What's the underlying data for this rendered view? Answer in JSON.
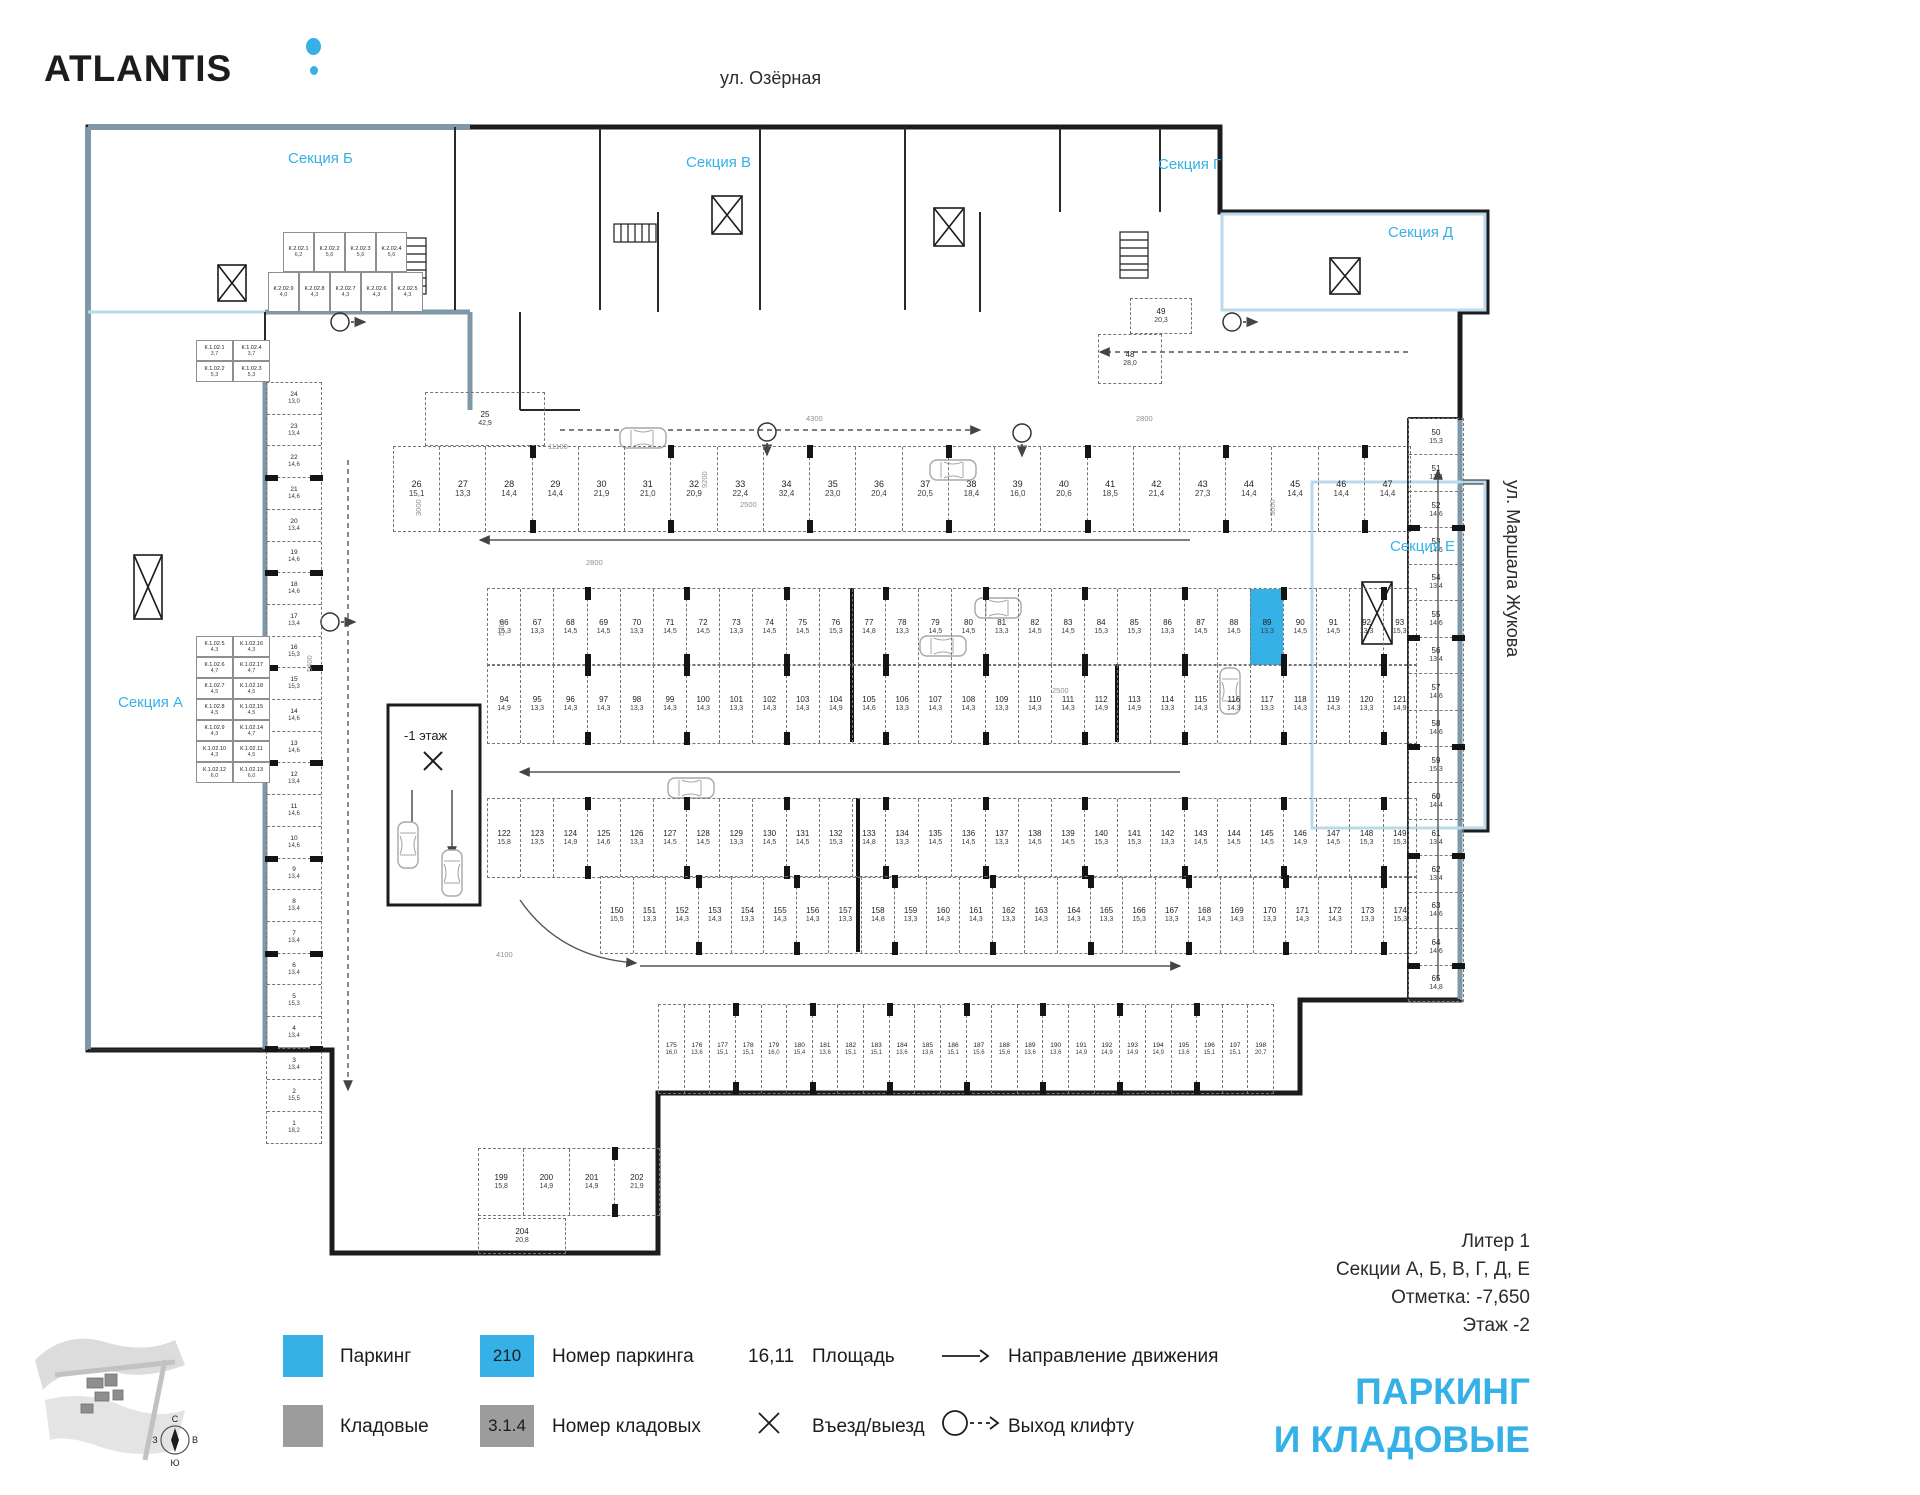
{
  "brand": {
    "name": "ATLANTIS"
  },
  "streets": {
    "top": "ул. Озёрная",
    "right": "ул. Маршала Жукова"
  },
  "section_labels": {
    "a": "Секция А",
    "b": "Секция Б",
    "v": "Секция В",
    "g": "Секция Г",
    "d": "Секция Д",
    "e": "Секция Е"
  },
  "ramp": {
    "label": "-1 этаж"
  },
  "selected_stall": "89",
  "colors": {
    "accent_cyan": "#35b1e7",
    "legend_gray": "#9c9c9c",
    "wall_black": "#1c1c1c",
    "wall_slate": "#7e97a9",
    "wall_lightblue": "#bcd9ec"
  },
  "rows": {
    "top": [
      {
        "n": "26",
        "a": "15,1"
      },
      {
        "n": "27",
        "a": "13,3"
      },
      {
        "n": "28",
        "a": "14,4"
      },
      {
        "n": "29",
        "a": "14,4"
      },
      {
        "n": "30",
        "a": "21,9"
      },
      {
        "n": "31",
        "a": "21,0"
      },
      {
        "n": "32",
        "a": "20,9"
      },
      {
        "n": "33",
        "a": "22,4"
      },
      {
        "n": "34",
        "a": "32,4"
      },
      {
        "n": "35",
        "a": "23,0"
      },
      {
        "n": "36",
        "a": "20,4"
      },
      {
        "n": "37",
        "a": "20,5"
      },
      {
        "n": "38",
        "a": "18,4"
      },
      {
        "n": "39",
        "a": "16,0"
      },
      {
        "n": "40",
        "a": "20,6"
      },
      {
        "n": "41",
        "a": "18,5"
      },
      {
        "n": "42",
        "a": "21,4"
      },
      {
        "n": "43",
        "a": "27,3"
      },
      {
        "n": "44",
        "a": "14,4"
      },
      {
        "n": "45",
        "a": "14,4"
      },
      {
        "n": "46",
        "a": "14,4"
      },
      {
        "n": "47",
        "a": "14,4"
      }
    ],
    "b1": [
      {
        "n": "66",
        "a": "15,3"
      },
      {
        "n": "67",
        "a": "13,3"
      },
      {
        "n": "68",
        "a": "14,5"
      },
      {
        "n": "69",
        "a": "14,5"
      },
      {
        "n": "70",
        "a": "13,3"
      },
      {
        "n": "71",
        "a": "14,5"
      },
      {
        "n": "72",
        "a": "14,5"
      },
      {
        "n": "73",
        "a": "13,3"
      },
      {
        "n": "74",
        "a": "14,5"
      },
      {
        "n": "75",
        "a": "14,5"
      },
      {
        "n": "76",
        "a": "15,3"
      },
      {
        "n": "77",
        "a": "14,8"
      },
      {
        "n": "78",
        "a": "13,3"
      },
      {
        "n": "79",
        "a": "14,5"
      },
      {
        "n": "80",
        "a": "14,5"
      },
      {
        "n": "81",
        "a": "13,3"
      },
      {
        "n": "82",
        "a": "14,5"
      },
      {
        "n": "83",
        "a": "14,5"
      },
      {
        "n": "84",
        "a": "15,3"
      },
      {
        "n": "85",
        "a": "15,3"
      },
      {
        "n": "86",
        "a": "13,3"
      },
      {
        "n": "87",
        "a": "14,5"
      },
      {
        "n": "88",
        "a": "14,5"
      },
      {
        "n": "89",
        "a": "13,3"
      },
      {
        "n": "90",
        "a": "14,5"
      },
      {
        "n": "91",
        "a": "14,5"
      },
      {
        "n": "92",
        "a": "13,3"
      },
      {
        "n": "93",
        "a": "15,3"
      }
    ],
    "b2": [
      {
        "n": "94",
        "a": "14,9"
      },
      {
        "n": "95",
        "a": "13,3"
      },
      {
        "n": "96",
        "a": "14,3"
      },
      {
        "n": "97",
        "a": "14,3"
      },
      {
        "n": "98",
        "a": "13,3"
      },
      {
        "n": "99",
        "a": "14,3"
      },
      {
        "n": "100",
        "a": "14,3"
      },
      {
        "n": "101",
        "a": "13,3"
      },
      {
        "n": "102",
        "a": "14,3"
      },
      {
        "n": "103",
        "a": "14,3"
      },
      {
        "n": "104",
        "a": "14,9"
      },
      {
        "n": "105",
        "a": "14,6"
      },
      {
        "n": "106",
        "a": "13,3"
      },
      {
        "n": "107",
        "a": "14,3"
      },
      {
        "n": "108",
        "a": "14,3"
      },
      {
        "n": "109",
        "a": "13,3"
      },
      {
        "n": "110",
        "a": "14,3"
      },
      {
        "n": "111",
        "a": "14,3"
      },
      {
        "n": "112",
        "a": "14,9"
      },
      {
        "n": "113",
        "a": "14,9"
      },
      {
        "n": "114",
        "a": "13,3"
      },
      {
        "n": "115",
        "a": "14,3"
      },
      {
        "n": "116",
        "a": "14,3"
      },
      {
        "n": "117",
        "a": "13,3"
      },
      {
        "n": "118",
        "a": "14,3"
      },
      {
        "n": "119",
        "a": "14,3"
      },
      {
        "n": "120",
        "a": "13,3"
      },
      {
        "n": "121",
        "a": "14,9"
      }
    ],
    "c1": [
      {
        "n": "122",
        "a": "15,8"
      },
      {
        "n": "123",
        "a": "13,5"
      },
      {
        "n": "124",
        "a": "14,9"
      },
      {
        "n": "125",
        "a": "14,6"
      },
      {
        "n": "126",
        "a": "13,3"
      },
      {
        "n": "127",
        "a": "14,5"
      },
      {
        "n": "128",
        "a": "14,5"
      },
      {
        "n": "129",
        "a": "13,3"
      },
      {
        "n": "130",
        "a": "14,5"
      },
      {
        "n": "131",
        "a": "14,5"
      },
      {
        "n": "132",
        "a": "15,3"
      },
      {
        "n": "133",
        "a": "14,8"
      },
      {
        "n": "134",
        "a": "13,3"
      },
      {
        "n": "135",
        "a": "14,5"
      },
      {
        "n": "136",
        "a": "14,5"
      },
      {
        "n": "137",
        "a": "13,3"
      },
      {
        "n": "138",
        "a": "14,5"
      },
      {
        "n": "139",
        "a": "14,5"
      },
      {
        "n": "140",
        "a": "15,3"
      },
      {
        "n": "141",
        "a": "15,3"
      },
      {
        "n": "142",
        "a": "13,3"
      },
      {
        "n": "143",
        "a": "14,5"
      },
      {
        "n": "144",
        "a": "14,5"
      },
      {
        "n": "145",
        "a": "14,5"
      },
      {
        "n": "146",
        "a": "14,9"
      },
      {
        "n": "147",
        "a": "14,5"
      },
      {
        "n": "148",
        "a": "15,3"
      },
      {
        "n": "149",
        "a": "15,3"
      }
    ],
    "c2": [
      {
        "n": "150",
        "a": "15,5"
      },
      {
        "n": "151",
        "a": "13,3"
      },
      {
        "n": "152",
        "a": "14,3"
      },
      {
        "n": "153",
        "a": "14,3"
      },
      {
        "n": "154",
        "a": "13,3"
      },
      {
        "n": "155",
        "a": "14,3"
      },
      {
        "n": "156",
        "a": "14,3"
      },
      {
        "n": "157",
        "a": "13,3"
      },
      {
        "n": "158",
        "a": "14,8"
      },
      {
        "n": "159",
        "a": "13,3"
      },
      {
        "n": "160",
        "a": "14,3"
      },
      {
        "n": "161",
        "a": "14,3"
      },
      {
        "n": "162",
        "a": "13,3"
      },
      {
        "n": "163",
        "a": "14,3"
      },
      {
        "n": "164",
        "a": "14,3"
      },
      {
        "n": "165",
        "a": "13,3"
      },
      {
        "n": "166",
        "a": "15,3"
      },
      {
        "n": "167",
        "a": "13,3"
      },
      {
        "n": "168",
        "a": "14,3"
      },
      {
        "n": "169",
        "a": "14,3"
      },
      {
        "n": "170",
        "a": "13,3"
      },
      {
        "n": "171",
        "a": "14,3"
      },
      {
        "n": "172",
        "a": "14,3"
      },
      {
        "n": "173",
        "a": "13,3"
      },
      {
        "n": "174",
        "a": "15,3"
      }
    ],
    "bottom": [
      {
        "n": "175",
        "a": "16,0"
      },
      {
        "n": "176",
        "a": "13,6"
      },
      {
        "n": "177",
        "a": "15,1"
      },
      {
        "n": "178",
        "a": "15,1"
      },
      {
        "n": "179",
        "a": "16,0"
      },
      {
        "n": "180",
        "a": "15,4"
      },
      {
        "n": "181",
        "a": "13,6"
      },
      {
        "n": "182",
        "a": "15,1"
      },
      {
        "n": "183",
        "a": "15,1"
      },
      {
        "n": "184",
        "a": "13,6"
      },
      {
        "n": "185",
        "a": "13,6"
      },
      {
        "n": "186",
        "a": "15,1"
      },
      {
        "n": "187",
        "a": "15,6"
      },
      {
        "n": "188",
        "a": "15,6"
      },
      {
        "n": "189",
        "a": "13,6"
      },
      {
        "n": "190",
        "a": "13,6"
      },
      {
        "n": "191",
        "a": "14,9"
      },
      {
        "n": "192",
        "a": "14,9"
      },
      {
        "n": "193",
        "a": "14,9"
      },
      {
        "n": "194",
        "a": "14,9"
      },
      {
        "n": "195",
        "a": "13,6"
      },
      {
        "n": "196",
        "a": "15,1"
      },
      {
        "n": "197",
        "a": "15,1"
      },
      {
        "n": "198",
        "a": "20,7"
      }
    ],
    "ramp_row": [
      {
        "n": "199",
        "a": "15,8"
      },
      {
        "n": "200",
        "a": "14,9"
      },
      {
        "n": "201",
        "a": "14,9"
      },
      {
        "n": "202",
        "a": "21,9"
      }
    ],
    "left_col": [
      {
        "n": "24",
        "a": "13,0"
      },
      {
        "n": "23",
        "a": "13,4"
      },
      {
        "n": "22",
        "a": "14,6"
      },
      {
        "n": "21",
        "a": "14,6"
      },
      {
        "n": "20",
        "a": "13,4"
      },
      {
        "n": "19",
        "a": "14,6"
      },
      {
        "n": "18",
        "a": "14,6"
      },
      {
        "n": "17",
        "a": "13,4"
      },
      {
        "n": "16",
        "a": "15,3"
      },
      {
        "n": "15",
        "a": "15,3"
      },
      {
        "n": "14",
        "a": "14,6"
      },
      {
        "n": "13",
        "a": "14,6"
      },
      {
        "n": "12",
        "a": "13,4"
      },
      {
        "n": "11",
        "a": "14,6"
      },
      {
        "n": "10",
        "a": "14,6"
      },
      {
        "n": "9",
        "a": "13,4"
      },
      {
        "n": "8",
        "a": "13,4"
      },
      {
        "n": "7",
        "a": "13,4"
      },
      {
        "n": "6",
        "a": "13,4"
      },
      {
        "n": "5",
        "a": "15,3"
      },
      {
        "n": "4",
        "a": "13,4"
      },
      {
        "n": "3",
        "a": "13,4"
      },
      {
        "n": "2",
        "a": "15,5"
      },
      {
        "n": "1",
        "a": "18,2"
      }
    ],
    "right_col": [
      {
        "n": "50",
        "a": "15,3"
      },
      {
        "n": "51",
        "a": "13,4"
      },
      {
        "n": "52",
        "a": "14,6"
      },
      {
        "n": "53",
        "a": "14,6"
      },
      {
        "n": "54",
        "a": "13,4"
      },
      {
        "n": "55",
        "a": "14,6"
      },
      {
        "n": "56",
        "a": "13,4"
      },
      {
        "n": "57",
        "a": "14,6"
      },
      {
        "n": "58",
        "a": "14,6"
      },
      {
        "n": "59",
        "a": "15,3"
      },
      {
        "n": "60",
        "a": "14,4"
      },
      {
        "n": "61",
        "a": "13,4"
      },
      {
        "n": "62",
        "a": "13,4"
      },
      {
        "n": "63",
        "a": "14,6"
      },
      {
        "n": "64",
        "a": "14,6"
      },
      {
        "n": "65",
        "a": "14,8"
      }
    ]
  },
  "singles": [
    {
      "n": "25",
      "a": "42,9"
    },
    {
      "n": "48",
      "a": "28,0"
    },
    {
      "n": "49",
      "a": "20,3"
    },
    {
      "n": "204",
      "a": "20,8"
    }
  ],
  "storages": {
    "top_row1": [
      {
        "n": "К.2.02.1",
        "a": "6,2"
      },
      {
        "n": "К.2.02.2",
        "a": "5,6"
      },
      {
        "n": "К.2.02.3",
        "a": "5,6"
      },
      {
        "n": "К.2.02.4",
        "a": "5,6"
      }
    ],
    "top_row2": [
      {
        "n": "К.2.02.9",
        "a": "4,0"
      },
      {
        "n": "К.2.02.8",
        "a": "4,3"
      },
      {
        "n": "К.2.02.7",
        "a": "4,3"
      },
      {
        "n": "К.2.02.6",
        "a": "4,3"
      },
      {
        "n": "К.2.02.5",
        "a": "4,3"
      }
    ],
    "left_g1": [
      {
        "n": "К.1.02.1",
        "a": "3,7"
      },
      {
        "n": "К.1.02.4",
        "a": "3,7"
      },
      {
        "n": "К.1.02.2",
        "a": "5,3"
      },
      {
        "n": "К.1.02.3",
        "a": "5,3"
      }
    ],
    "left_g2": [
      {
        "n": "К.1.02.5",
        "a": "4,3"
      },
      {
        "n": "К.1.02.16",
        "a": "4,3"
      },
      {
        "n": "К.1.02.6",
        "a": "4,7"
      },
      {
        "n": "К.1.02.17",
        "a": "4,7"
      },
      {
        "n": "К.1.02.7",
        "a": "4,5"
      },
      {
        "n": "К.1.02.18",
        "a": "4,5"
      },
      {
        "n": "К.1.02.8",
        "a": "4,5"
      },
      {
        "n": "К.1.02.15",
        "a": "4,5"
      },
      {
        "n": "К.1.02.9",
        "a": "4,3"
      },
      {
        "n": "К.1.02.14",
        "a": "4,7"
      },
      {
        "n": "К.1.02.10",
        "a": "4,3"
      },
      {
        "n": "К.1.02.11",
        "a": "4,5"
      },
      {
        "n": "К.1.02.12",
        "a": "6,0"
      },
      {
        "n": "К.1.02.13",
        "a": "6,0"
      }
    ]
  },
  "legend": {
    "parking_label": "Паркинг",
    "storage_label": "Кладовые",
    "parking_num_sample": "210",
    "parking_num_label": "Номер паркинга",
    "storage_num_sample": "3.1.4",
    "storage_num_label": "Номер кладовых",
    "area_sample": "16,11",
    "area_label": "Площадь",
    "entry_label": "Въезд/выезд",
    "direction_label": "Направление движения",
    "lift_label": "Выход клифту"
  },
  "title_block": {
    "line1": "Литер 1",
    "line2": "Секции А, Б, В, Г, Д, Е",
    "line3": "Отметка:  -7,650",
    "line4": "Этаж  -2",
    "big1": "ПАРКИНГ",
    "big2": "И КЛАДОВЫЕ"
  },
  "compass": {
    "n": "С",
    "e": "В",
    "s": "Ю",
    "w": "З"
  },
  "dims": [
    "11100",
    "9200",
    "2500",
    "5300",
    "2800",
    "3000",
    "5400",
    "2500",
    "3000",
    "4100",
    "4300",
    "2800"
  ]
}
